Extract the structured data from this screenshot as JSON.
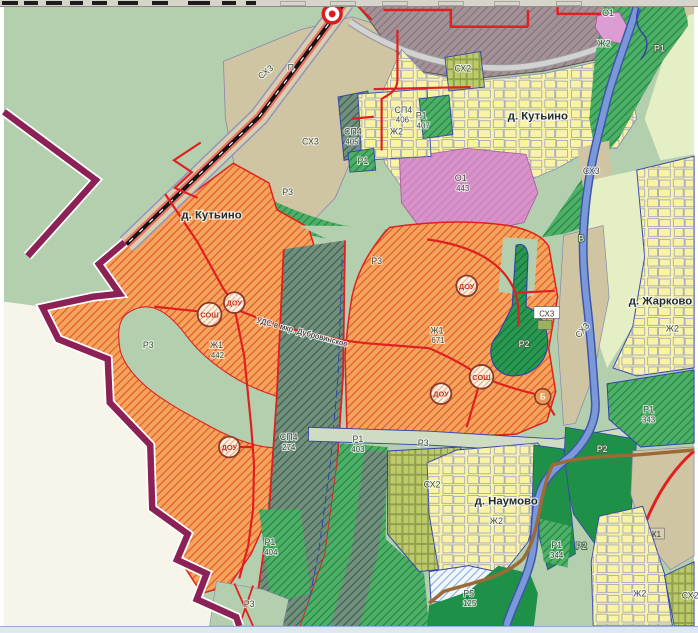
{
  "map": {
    "labels": [
      {
        "t": "П"
      },
      {
        "t": "СХ3"
      },
      {
        "t": "СХ3"
      },
      {
        "t": "Р3"
      },
      {
        "t": "д. Кутьино"
      },
      {
        "t": "СХ2"
      },
      {
        "t": "СП4"
      },
      {
        "t": "405"
      },
      {
        "t": "Ж2"
      },
      {
        "t": "СП4"
      },
      {
        "t": "406"
      },
      {
        "t": "Р1"
      },
      {
        "t": "407"
      },
      {
        "t": "Р1"
      },
      {
        "t": "О1"
      },
      {
        "t": "443"
      },
      {
        "t": "д. Кутьино"
      },
      {
        "t": "О1"
      },
      {
        "t": "Ж2"
      },
      {
        "t": "Р1"
      },
      {
        "t": "СХ3"
      },
      {
        "t": "В"
      },
      {
        "t": "д. Жарково"
      },
      {
        "t": "Ж2"
      },
      {
        "t": "Р3"
      },
      {
        "t": "Р3"
      },
      {
        "t": "Ж1"
      },
      {
        "t": "442"
      },
      {
        "t": "УДС в мкр. Дубровинское"
      },
      {
        "t": "Ж1"
      },
      {
        "t": "671"
      },
      {
        "t": "Р2"
      },
      {
        "t": "СХ3"
      },
      {
        "t": "СХ3"
      },
      {
        "t": "СП4"
      },
      {
        "t": "274"
      },
      {
        "t": "Р1"
      },
      {
        "t": "403"
      },
      {
        "t": "Р3"
      },
      {
        "t": "Р1"
      },
      {
        "t": "404"
      },
      {
        "t": "СХ2"
      },
      {
        "t": "д. Наумово"
      },
      {
        "t": "Ж2"
      },
      {
        "t": "Р2"
      },
      {
        "t": "Р1"
      },
      {
        "t": "343"
      },
      {
        "t": "Р2"
      },
      {
        "t": "Р1"
      },
      {
        "t": "344"
      },
      {
        "t": "Р5"
      },
      {
        "t": "125"
      },
      {
        "t": "Р3"
      },
      {
        "t": "Ж2"
      },
      {
        "t": "СХ2"
      },
      {
        "t": "К1"
      }
    ],
    "symbols": {
      "school": "СОШ",
      "kindergarten": "ДОУ",
      "bath": "Б"
    },
    "colors": {
      "residential_planned_zh1": "#f5a55b",
      "residential_existing_zh2": "#faf3a3",
      "garden_sx2": "#bccb67",
      "agricultural_sx3": "#d0c5a2",
      "special_sp4": "#71907e",
      "recreation_r1": "#4fae68",
      "recreation_r2": "#1f9048",
      "public_o1": "#d892ca",
      "industrial_p": "#a39298",
      "municipal_boundary": "#8c2155",
      "river": "#7b99d9",
      "road_red": "#e02020",
      "background": "#b4cfae"
    }
  }
}
